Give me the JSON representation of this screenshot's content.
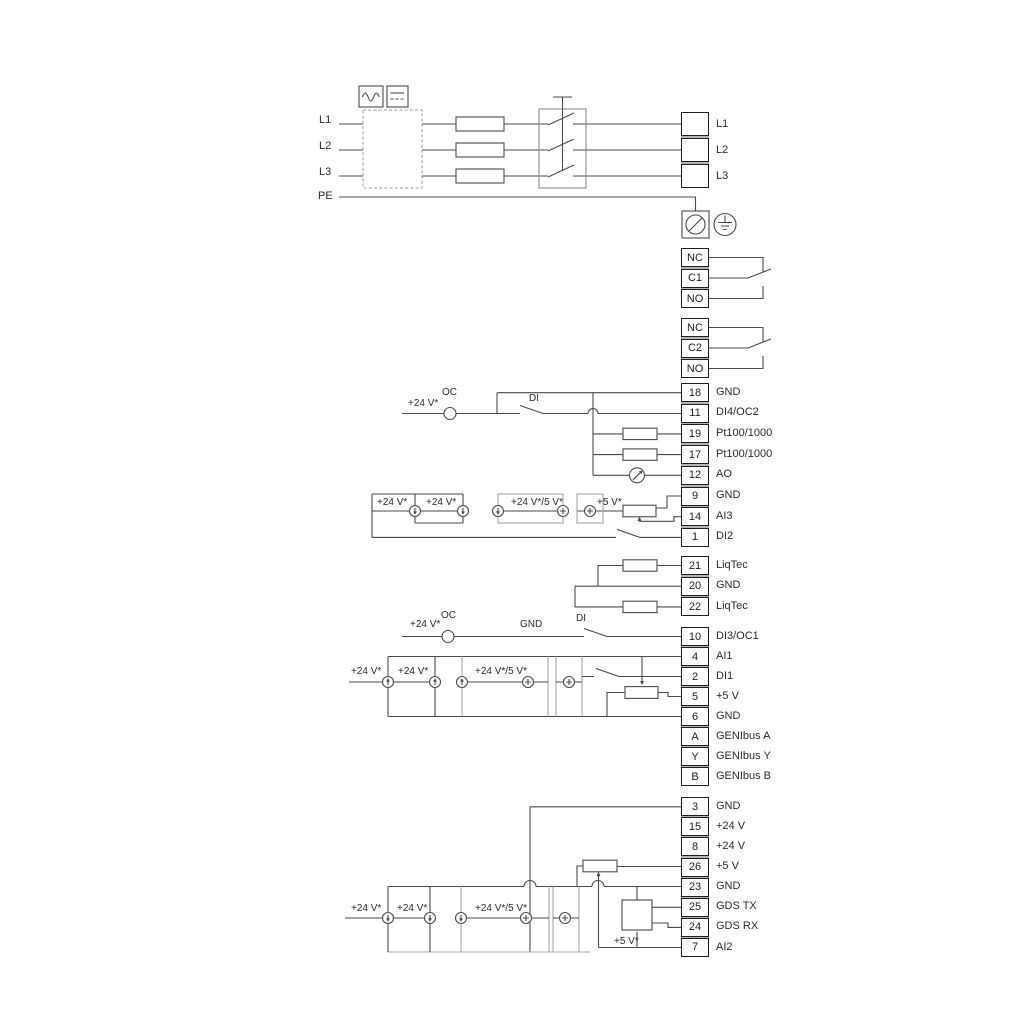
{
  "power": {
    "input_lines": [
      "L1",
      "L2",
      "L3",
      "PE"
    ],
    "output_lines": [
      "L1",
      "L2",
      "L3"
    ]
  },
  "relay1": {
    "nc": "NC",
    "c": "C1",
    "no": "NO"
  },
  "relay2": {
    "nc": "NC",
    "c": "C2",
    "no": "NO"
  },
  "ann": {
    "v24": "+24 V*",
    "v24_5": "+24 V*/5 V*",
    "v5": "+5 V*",
    "oc": "OC",
    "di": "DI",
    "gnd": "GND"
  },
  "strips": {
    "a": [
      {
        "n": "18",
        "label": "GND"
      },
      {
        "n": "11",
        "label": "DI4/OC2"
      },
      {
        "n": "19",
        "label": "Pt100/1000"
      },
      {
        "n": "17",
        "label": "Pt100/1000"
      },
      {
        "n": "12",
        "label": "AO"
      },
      {
        "n": "9",
        "label": "GND"
      },
      {
        "n": "14",
        "label": "AI3"
      },
      {
        "n": "1",
        "label": "DI2"
      }
    ],
    "b": [
      {
        "n": "21",
        "label": "LiqTec"
      },
      {
        "n": "20",
        "label": "GND"
      },
      {
        "n": "22",
        "label": "LiqTec"
      }
    ],
    "c": [
      {
        "n": "10",
        "label": "DI3/OC1"
      },
      {
        "n": "4",
        "label": "AI1"
      },
      {
        "n": "2",
        "label": "DI1"
      },
      {
        "n": "5",
        "label": "+5 V"
      },
      {
        "n": "6",
        "label": "GND"
      },
      {
        "n": "A",
        "label": "GENIbus A"
      },
      {
        "n": "Y",
        "label": "GENIbus Y"
      },
      {
        "n": "B",
        "label": "GENIbus B"
      }
    ],
    "d": [
      {
        "n": "3",
        "label": "GND"
      },
      {
        "n": "15",
        "label": "+24 V"
      },
      {
        "n": "8",
        "label": "+24 V"
      },
      {
        "n": "26",
        "label": "+5 V"
      },
      {
        "n": "23",
        "label": "GND"
      },
      {
        "n": "25",
        "label": "GDS TX"
      },
      {
        "n": "24",
        "label": "GDS RX"
      },
      {
        "n": "7",
        "label": "AI2"
      }
    ]
  }
}
